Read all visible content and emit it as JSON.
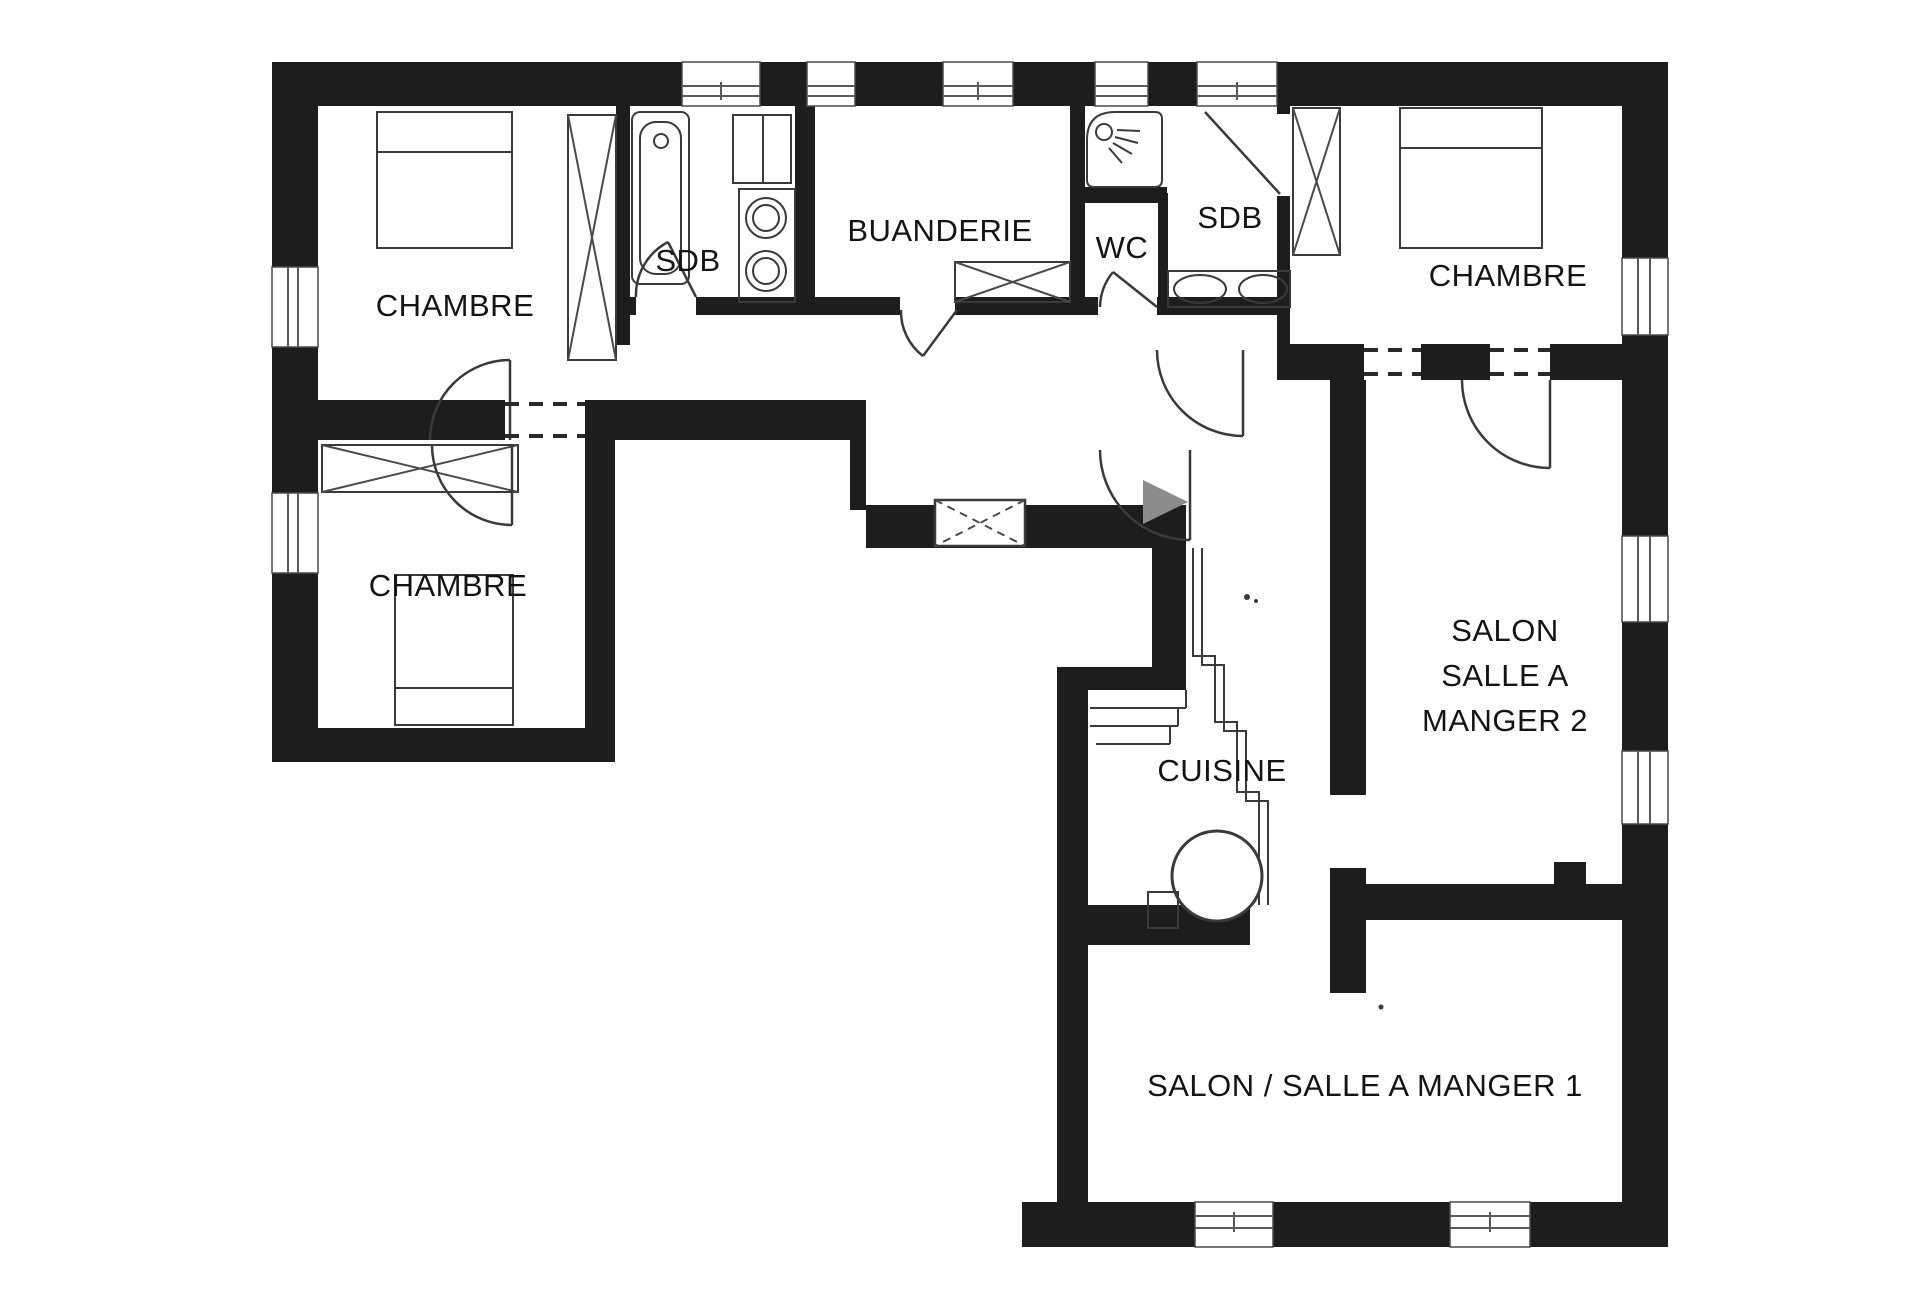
{
  "plan": {
    "type": "floor-plan",
    "background_color": "#ffffff",
    "wall_color": "#1d1d1d",
    "line_color": "#3a3a3a",
    "label_color": "#141414",
    "entrance_arrow_color": "#8c8c8c",
    "labels": {
      "chambre_top_left": "CHAMBRE",
      "sdb_left": "SDB",
      "buanderie": "BUANDERIE",
      "wc": "WC",
      "sdb_right": "SDB",
      "chambre_top_right": "CHAMBRE",
      "chambre_bottom_left": "CHAMBRE",
      "salon2_line1": "SALON",
      "salon2_line2": "SALLE A",
      "salon2_line3": "MANGER 2",
      "cuisine": "CUISINE",
      "salon1": "SALON / SALLE A MANGER 1"
    }
  }
}
